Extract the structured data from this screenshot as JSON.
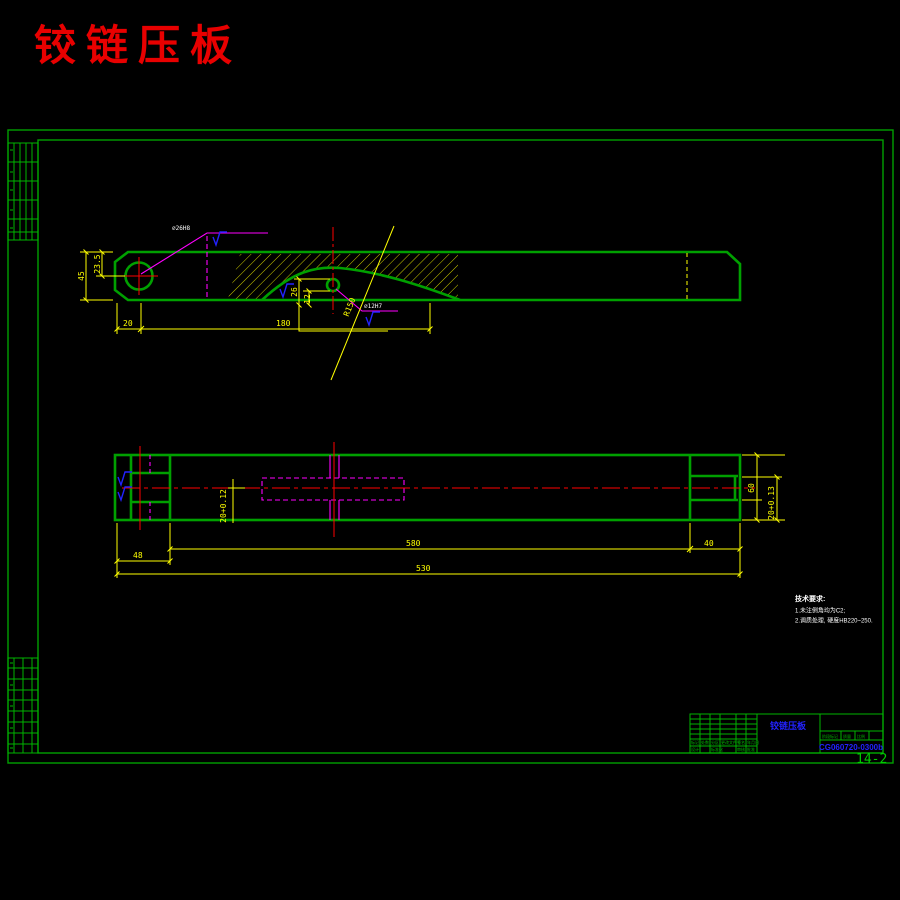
{
  "title": "铰链压板",
  "views": {
    "front": {
      "dim_45": "45",
      "dim_23_5": "23.5",
      "dim_20": "20",
      "dim_180": "180",
      "dim_26": "26",
      "dim_12": "12",
      "radius_label": "R150",
      "hole_callout": "∅26H8",
      "small_hole_callout": "∅12H7"
    },
    "plan": {
      "dim_slot_left": "20+0.12",
      "dim_height": "60",
      "dim_slot_right": "20+0.13",
      "dim_48": "48",
      "dim_580": "580",
      "dim_530": "530",
      "dim_40": "40"
    }
  },
  "notes": {
    "heading": "技术要求:",
    "item1": "1.未注倒角均为C2;",
    "item2": "2.调质处理, 硬度HB220~250."
  },
  "title_block": {
    "part_name": "铰链压板",
    "drawing_no": "CG060720-0300b",
    "sheet_label": "14-2",
    "labels": {
      "mark": "标记",
      "count": "处数",
      "zone": "分区",
      "doc_no": "更改文件号",
      "sign": "签名",
      "date": "年月日",
      "design": "设计",
      "standard": "标准化",
      "check": "审核",
      "approve": "批准",
      "stage": "阶段标记",
      "weight": "质量",
      "scale": "比例"
    }
  },
  "colors": {
    "line_green": "#00a000",
    "dim_yellow": "#ffff00",
    "center_red": "#ff0000",
    "hidden_magenta": "#ff00ff",
    "symbol_blue": "#2222ff",
    "title_red": "#e80000",
    "text_white": "#ffffff"
  }
}
